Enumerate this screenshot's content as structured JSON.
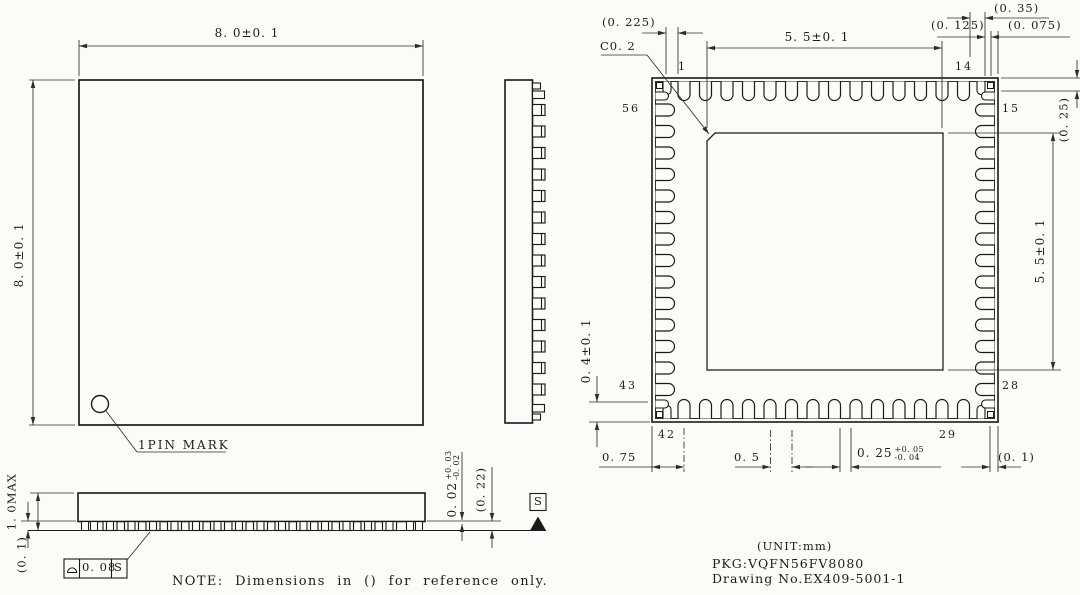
{
  "colors": {
    "background": "#fbfbf9",
    "line": "#1a1a1a",
    "dim_line": "#2d2d2d"
  },
  "note": "NOTE: Dimensions in () for reference only.",
  "title_block": {
    "unit": "(UNIT:mm)",
    "package": "PKG:VQFN56FV8080",
    "drawing_no": "Drawing No.EX409-5001-1"
  },
  "top_view": {
    "width_dim": "8. 0±0. 1",
    "height_dim": "8. 0±0. 1",
    "pin1_mark_label": "1PIN MARK"
  },
  "bottom_view": {
    "corner_offset_dim": "(0. 225)",
    "chamfer_dim": "C0. 2",
    "pad_width_dim": "5. 5±0. 1",
    "pad_height_dim": "5. 5±0. 1",
    "corner_dim_a": "(0. 35)",
    "corner_dim_b": "(0. 125)",
    "corner_dim_c": "(0. 075)",
    "corner_lead_dim": "(0. 25)",
    "lead_length_dim": "0. 4±0. 1",
    "edge_to_pin_dim": "0. 75",
    "pitch_dim": "0. 5",
    "lead_width_dim": {
      "value": "0. 25",
      "tol_plus": "+0. 05",
      "tol_minus": "-0. 04"
    },
    "corner_gap_dim": "(0. 1)",
    "pin_numbers": {
      "p1": "1",
      "p14": "14",
      "p15": "15",
      "p28": "28",
      "p29": "29",
      "p42": "42",
      "p43": "43",
      "p56": "56"
    }
  },
  "profile_view": {
    "height_dim": "1. 0MAX",
    "standoff_ref_dim": "(0. 1)",
    "standoff_dim": {
      "value": "0. 02",
      "tol_plus": "+0. 03",
      "tol_minus": "-0. 02"
    },
    "lead_thickness_dim": "(0. 22)",
    "flatness": {
      "tolerance": "0. 08",
      "datum": "S"
    },
    "datum_label": "S"
  }
}
